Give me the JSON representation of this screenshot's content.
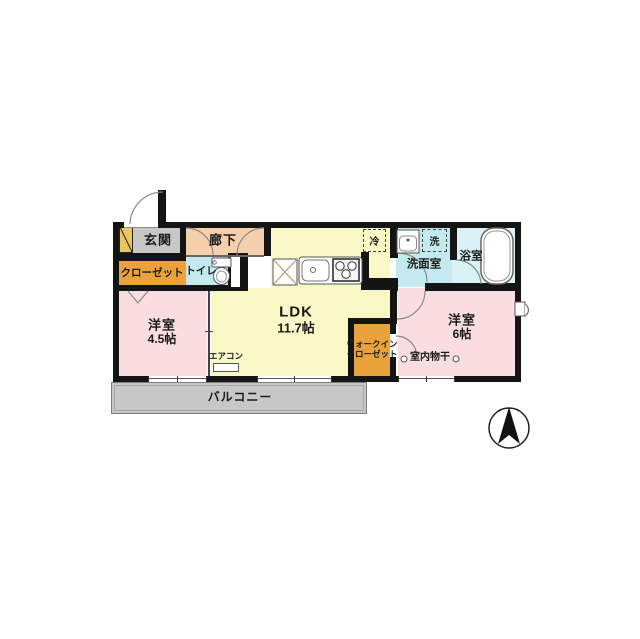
{
  "colors": {
    "wall": "#141414",
    "ldk": "#faf8c6",
    "hall": "#f6cfad",
    "closet": "#e9a23c",
    "water": "#c4eaf0",
    "bath": "#d8f2f5",
    "bedroom": "#fadde1",
    "entry": "#c7c7c7",
    "balcony": "#c7c7c7",
    "shoe": "#edc45f",
    "line": "#666666"
  },
  "rooms": {
    "genkan": {
      "label": "玄関"
    },
    "rouka": {
      "label": "廊下"
    },
    "closet": {
      "label": "クローゼット"
    },
    "toilet": {
      "label": "トイレ"
    },
    "ldk": {
      "label": "LDK",
      "size": "11.7帖"
    },
    "senmenshitsu": {
      "label": "洗面室"
    },
    "yokushitsu": {
      "label": "浴室"
    },
    "bedroom_45": {
      "label": "洋室",
      "size": "4.5帖"
    },
    "bedroom_6": {
      "label": "洋室",
      "size": "6帖"
    },
    "wic": {
      "line1": "ウォークイン",
      "line2": "クローゼット"
    },
    "balcony": {
      "label": "バルコニー"
    }
  },
  "fixtures": {
    "refrigerator": {
      "label": "冷"
    },
    "washer": {
      "label": "洗"
    },
    "aircon": {
      "label": "エアコン"
    },
    "drying": {
      "label": "室内物干"
    }
  }
}
